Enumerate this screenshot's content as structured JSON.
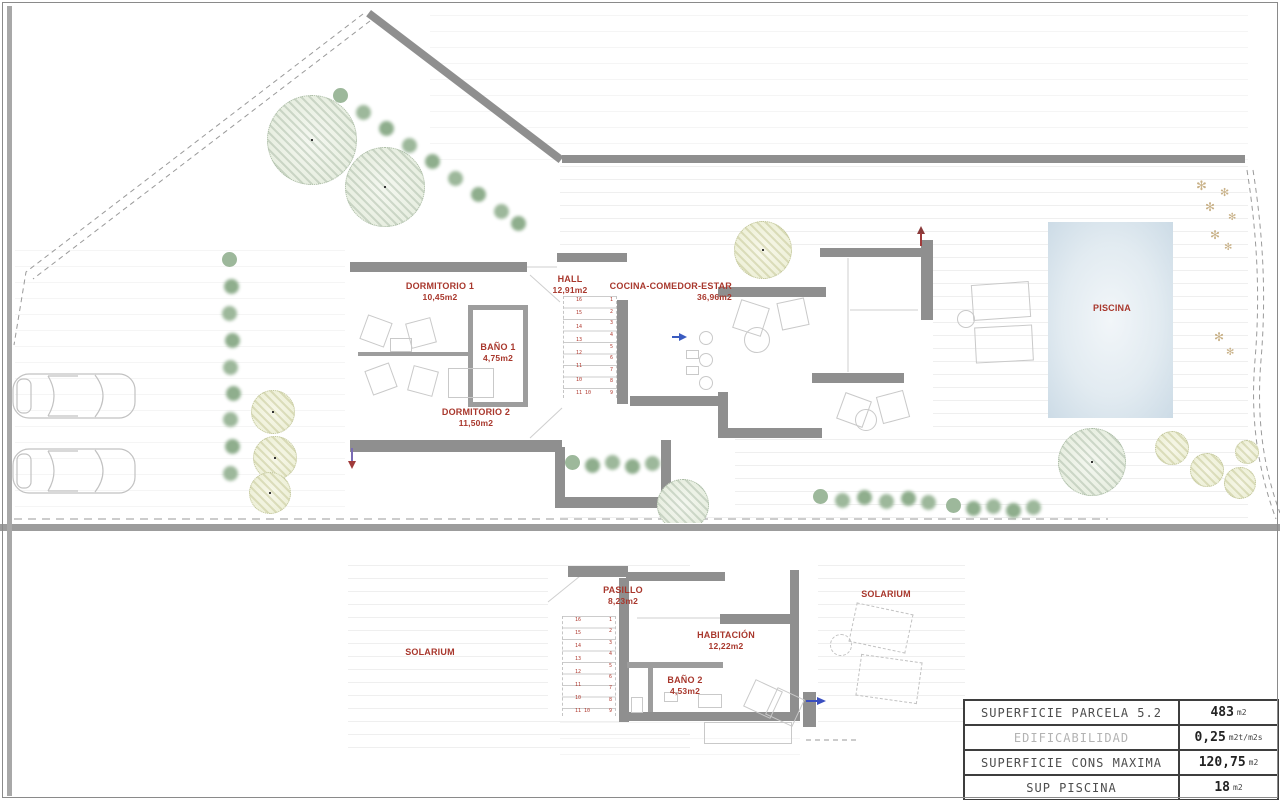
{
  "colors": {
    "wall": "#8f8f8f",
    "room_label": "#a8372c",
    "pool_fill": "#dce8f0",
    "divider": "#9c9c9c",
    "table_border": "#3e3e3e"
  },
  "site_plan": {
    "rooms": {
      "dormitorio1": {
        "name": "DORMITORIO 1",
        "area": "10,45m2"
      },
      "hall": {
        "name": "HALL",
        "area": "12,91m2"
      },
      "cocina": {
        "name": "COCINA-COMEDOR-ESTAR",
        "area": "36,96m2"
      },
      "bano1": {
        "name": "BAÑO 1",
        "area": "4,75m2"
      },
      "dormitorio2": {
        "name": "DORMITORIO 2",
        "area": "11,50m2"
      },
      "piscina": {
        "name": "PISCINA"
      }
    },
    "stairs": {
      "left_numbers": [
        "16",
        "15",
        "14",
        "13",
        "12",
        "11",
        "10",
        "11 10"
      ],
      "right_numbers": [
        "1",
        "2",
        "3",
        "4",
        "5",
        "6",
        "7",
        "8",
        "9"
      ]
    }
  },
  "first_floor_plan": {
    "rooms": {
      "pasillo": {
        "name": "PASILLO",
        "area": "8,23m2"
      },
      "solarium_left": {
        "name": "SOLARIUM"
      },
      "habitacion": {
        "name": "HABITACIÓN",
        "area": "12,22m2"
      },
      "bano2": {
        "name": "BAÑO 2",
        "area": "4,53m2"
      },
      "solarium_right": {
        "name": "SOLARIUM"
      }
    }
  },
  "summary_table": {
    "rows": [
      {
        "label": "SUPERFICIE PARCELA 5.2",
        "value": "483",
        "unit": "m2"
      },
      {
        "label": "EDIFICABILIDAD",
        "value": "0,25",
        "unit": "m2t/m2s"
      },
      {
        "label": "SUPERFICIE CONS MAXIMA",
        "value": "120,75",
        "unit": "m2"
      },
      {
        "label": "SUP PISCINA",
        "value": "18",
        "unit": "m2"
      }
    ]
  }
}
